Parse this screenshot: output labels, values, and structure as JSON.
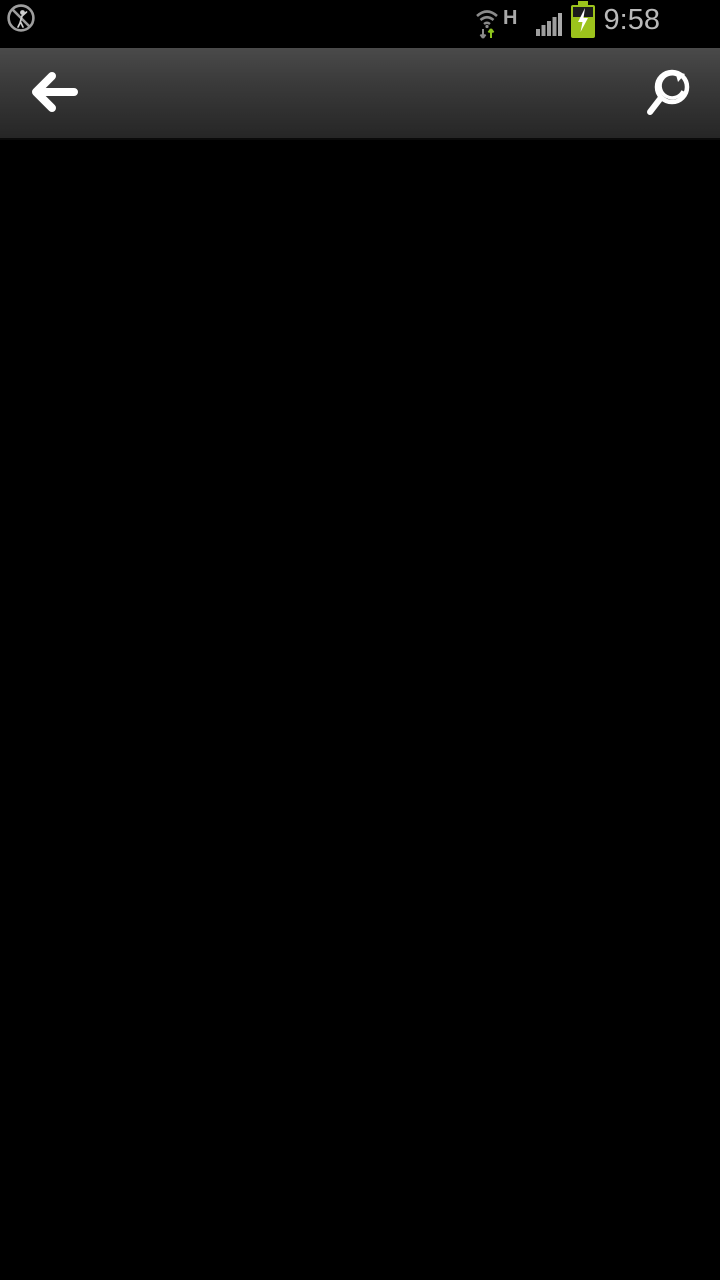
{
  "status_bar": {
    "time": "9:58",
    "network_type": "H",
    "bg": "#000000",
    "icon_color": "#9e9e9e",
    "time_color": "#b9b9b9",
    "wifi_up_arrow_color": "#8dc41e",
    "wifi_down_arrow_color": "#8a8a8a",
    "battery_color": "#9cc31c",
    "battery_bolt_color": "#ffffff"
  },
  "toolbar": {
    "back_icon_color": "#ffffff",
    "zoom_icon_color": "#ffffff",
    "bg_top": "#4a4a4a",
    "bg_bottom": "#262626"
  },
  "canvas": {
    "bg": "#000000",
    "palette": {
      "border": "#00dce8",
      "dim": "#00cc00",
      "wall": "#e0813c",
      "wall_red": "#e03010",
      "red_text": "#ff2800",
      "furniture": "#8f8f8f",
      "fixture": "#00bfc8",
      "core_yellow": "#f2e02a",
      "teal": "#0c7078",
      "title_green": "#00d400",
      "title_block": "#e8480e",
      "title_block_bg": "#300a00",
      "white": "#e0e0e0",
      "yellow": "#f2ee1e",
      "outline_white": "#f0f0f0"
    },
    "sheets": [
      {
        "x": 163,
        "y": 98,
        "w": 245,
        "h": 172,
        "s": 0.68
      },
      {
        "x": 421,
        "y": 98,
        "w": 230,
        "h": 172,
        "s": 0.66
      },
      {
        "x": 163,
        "y": 274,
        "w": 245,
        "h": 172,
        "s": 0.74
      },
      {
        "x": 421,
        "y": 274,
        "w": 230,
        "h": 172,
        "s": 0.72
      },
      {
        "x": 163,
        "y": 450,
        "w": 245,
        "h": 168,
        "s": 0.76
      },
      {
        "x": 421,
        "y": 450,
        "w": 230,
        "h": 168,
        "s": 0.74
      },
      {
        "x": 163,
        "y": 622,
        "w": 245,
        "h": 164,
        "s": 0.72
      },
      {
        "x": 421,
        "y": 622,
        "w": 230,
        "h": 164,
        "s": 0.7
      },
      {
        "x": 163,
        "y": 788,
        "w": 267,
        "h": 190,
        "s": 0.76
      },
      {
        "x": 444,
        "y": 788,
        "w": 258,
        "h": 190,
        "s": 0.74
      }
    ],
    "motif_layers": [
      {
        "c": "#f2ee1e",
        "r": [
          [
            20,
            0,
            24,
            9
          ],
          [
            72,
            0,
            24,
            9
          ],
          [
            7,
            70,
            41,
            9
          ],
          [
            65,
            70,
            41,
            9
          ]
        ]
      },
      {
        "c": "#00dce8",
        "d": "M0,14 H20 V5 H45 V14 H52 V9 H62 V14 H69 V5 H94 V14 H114 V46 H105 V73 H62 V64 H52 V73 H9 V46 H0 Z"
      },
      {
        "c": "#f0f0f0",
        "d": "M4,17 H24 V9 H42 V17 H52 V12 H62 V17 H72 V9 H90 V17 H110 V44 H101 V69 H64 V61 H50 V69 H13 V44 H4 Z"
      },
      {
        "c": "#f0f0f0",
        "d": "M37,21 H77 V31 H62 V70 H52 V31 H37 Z"
      }
    ],
    "outlines": [
      {
        "x": 46,
        "y": 135,
        "w": 116,
        "h": 84,
        "use_motif": true,
        "t": "translate(1,1)"
      },
      {
        "x": 0,
        "y": 303,
        "w": 94,
        "h": 88,
        "use_motif": true,
        "t": "translate(-45,2) scale(1.2,1.05)"
      },
      {
        "x": 0,
        "y": 483,
        "w": 124,
        "h": 84,
        "use_motif": true,
        "t": "translate(-14,1) scale(1.2,1)"
      },
      {
        "x": 0,
        "y": 650,
        "w": 54,
        "h": 92,
        "use_motif": false,
        "layers": [
          {
            "c": "#f2ee1e",
            "r": [
              [
                0,
                2,
                3,
                14
              ],
              [
                0,
                74,
                28,
                14
              ]
            ]
          },
          {
            "c": "#00dce8",
            "d": "M0,16 H44 V30 H50 V70 H28 V84 H0"
          },
          {
            "c": "#f0f0f0",
            "d": "M0,20 H40 V34 H46 V66 H24 V80 H0"
          }
        ]
      }
    ],
    "fragments": [
      {
        "x": 713,
        "y": 345,
        "w": 7,
        "h": 43,
        "c": "#e0e0e0"
      },
      {
        "x": 705,
        "y": 505,
        "w": 15,
        "h": 52,
        "c": "#8a8a8a"
      }
    ],
    "edge_line": {
      "x": 0,
      "y": 1097,
      "w": 691,
      "h": 2,
      "c": "#2a4ecf"
    }
  }
}
